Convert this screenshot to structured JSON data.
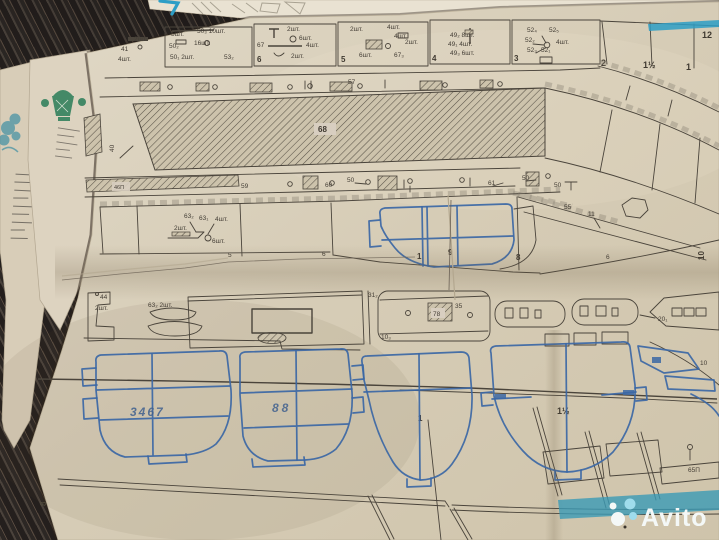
{
  "photo": {
    "watermark": {
      "brand": "Avito"
    },
    "colors": {
      "accent_cyan": "#2d9ec6",
      "pen_blue": "#3b67a5",
      "ink": "#4a443b",
      "paper": "#d8cec0",
      "watermark_teal": "#3a9ab5",
      "green_print": "#2a7d58"
    }
  },
  "plan": {
    "page_number": "8",
    "top_row": {
      "pre": [
        "2шт.",
        "41",
        "4шт."
      ],
      "box7": [
        "5шт.",
        "50₃ 10шт.",
        "16шт.",
        "50₂",
        "50₁ 2шт.",
        "53₂"
      ],
      "box6_num": "6",
      "box6": [
        "2шт.",
        "6шт.",
        "67",
        "4шт.",
        "2шт."
      ],
      "box5_num": "5",
      "box5": [
        "2шт.",
        "4шт.",
        "4шт.",
        "2шт.",
        "6шт.",
        "67₃"
      ],
      "box4_num": "4",
      "box4": [
        "49₂ 8шт.",
        "49₁ 4шт.",
        "49₃ 6шт."
      ],
      "box3_num": "3",
      "box3": [
        "52₄",
        "52₅",
        "52₂",
        "4шт.",
        "52₃",
        "52₁"
      ],
      "sections": [
        "2",
        "1½",
        "1"
      ],
      "corner_num": "12"
    },
    "strip1": {
      "label": "57"
    },
    "deck": {
      "num": "68",
      "side_num": "40",
      "bar_label": "46П"
    },
    "strip2": {
      "labels": [
        "59",
        "60",
        "50",
        "61",
        "50",
        "50"
      ]
    },
    "panels": {
      "parts": [
        "63₂",
        "63₁",
        "4шт.",
        "2шт.",
        "6шт."
      ],
      "nums": [
        "5",
        "6"
      ],
      "frame_nums": [
        "1",
        "9",
        "8"
      ],
      "slope": [
        "55",
        "11"
      ],
      "slope_num": "6",
      "side_num": "10"
    },
    "cabin": {
      "part1": "44",
      "part1_qty": "2шт.",
      "part2": "63₂ 2шт.",
      "panel_num": "31₂",
      "hatch_num": "78",
      "small_num": "35",
      "corner_num": "10₃",
      "boat_num": "20₁"
    },
    "frames": {
      "hand1": "3467",
      "hand2": "88",
      "f3_num": "1",
      "f4_num": "1½",
      "bow_num": "10",
      "strip_num": "65П"
    }
  }
}
